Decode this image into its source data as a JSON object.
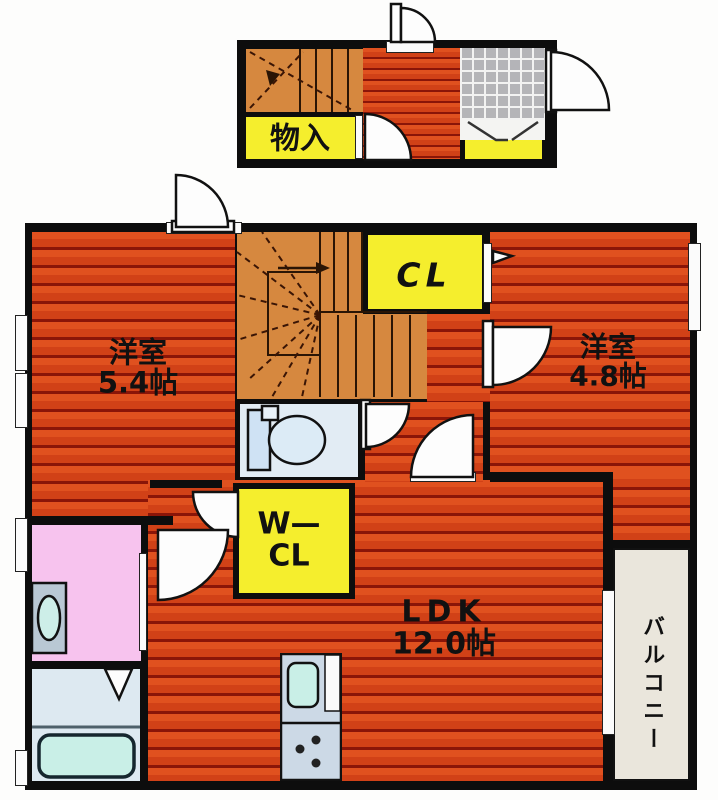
{
  "floor_plan": {
    "upper_floor": {
      "storage_label": "物入"
    },
    "main_floor": {
      "closet_label": "CL",
      "bedroom_left": {
        "type": "洋室",
        "size": "5.4帖"
      },
      "bedroom_right": {
        "type": "洋室",
        "size": "4.8帖"
      },
      "walk_in_closet": {
        "line1": "W—",
        "line2": "CL"
      },
      "ldk": {
        "type": "LDK",
        "size": "12.0帖"
      },
      "balcony_label": "バルコニー"
    },
    "colors": {
      "flooring_red": "#d9481f",
      "flooring_stripe": "#8a1508",
      "stairs_orange": "#d6883f",
      "closet_yellow": "#f5ee2d",
      "washroom_pink": "#f7c3ee",
      "bath_blue": "#dde9f1",
      "balcony_beige": "#eae6dc",
      "entrance_tile_gray": "#b4b4b8",
      "wall_black": "#0d0d0d"
    }
  }
}
